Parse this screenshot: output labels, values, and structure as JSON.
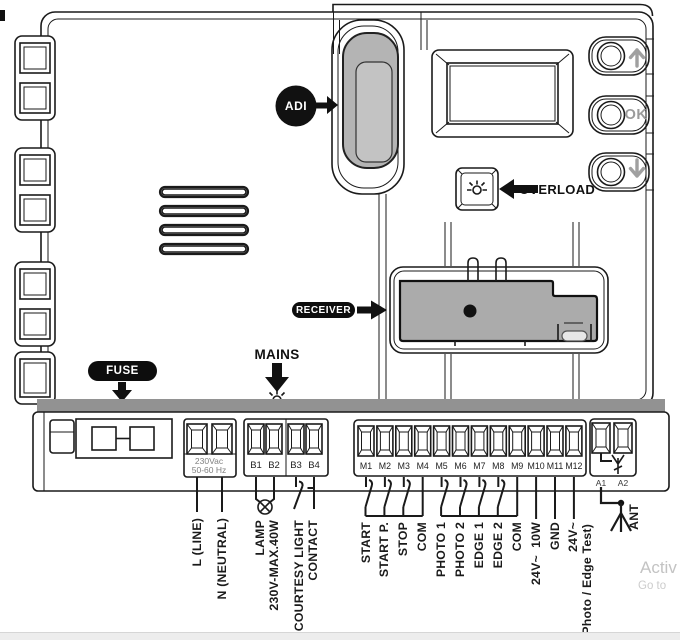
{
  "diagram": {
    "badge_adi": "ADI",
    "overload_label": "OVERLOAD",
    "receiver_label": "RECEIVER",
    "mains_label": "MAINS",
    "fuse_label": "FUSE",
    "ok_button": "OK",
    "power_rating_line1": "230Vac",
    "power_rating_line2": "50-60 Hz",
    "b_terminals": [
      "B1",
      "B2",
      "B3",
      "B4"
    ],
    "m_terminals": [
      "M1",
      "M2",
      "M3",
      "M4",
      "M5",
      "M6",
      "M7",
      "M8",
      "M9",
      "M10",
      "M11",
      "M12"
    ],
    "a_terminals": [
      "A1",
      "A2"
    ],
    "wire_labels": {
      "line": "L (LINE)",
      "neutral": "N (NEUTRAL)",
      "lamp_line1": "LAMP",
      "lamp_line2": "230V-MAX.40W",
      "courtesy_line1": "COURTESY LIGHT",
      "courtesy_line2": "CONTACT",
      "m": [
        "START",
        "START P.",
        "STOP",
        "COM",
        "PHOTO 1",
        "PHOTO 2",
        "EDGE 1",
        "EDGE 2",
        "COM",
        "24V~  10W",
        "GND",
        "24V~"
      ],
      "photo_edge_test": "(Photo / Edge Test)",
      "antenna": "ANT"
    },
    "icons": {
      "up_arrow": "up-arrow-icon",
      "down_arrow": "down-arrow-icon",
      "led": "led-indicator-icon",
      "lamp": "lamp-symbol-icon",
      "antenna": "antenna-symbol-icon"
    }
  },
  "watermark": {
    "line1": "Activ",
    "line2": "Go to"
  },
  "colors": {
    "line": "#1a1a1a",
    "module_gray": "#ababab",
    "port_gray": "#b4b4b4",
    "muted_label": "#808080",
    "button_glyph": "#a0a0a0",
    "watermark": "#c6c6c6"
  }
}
